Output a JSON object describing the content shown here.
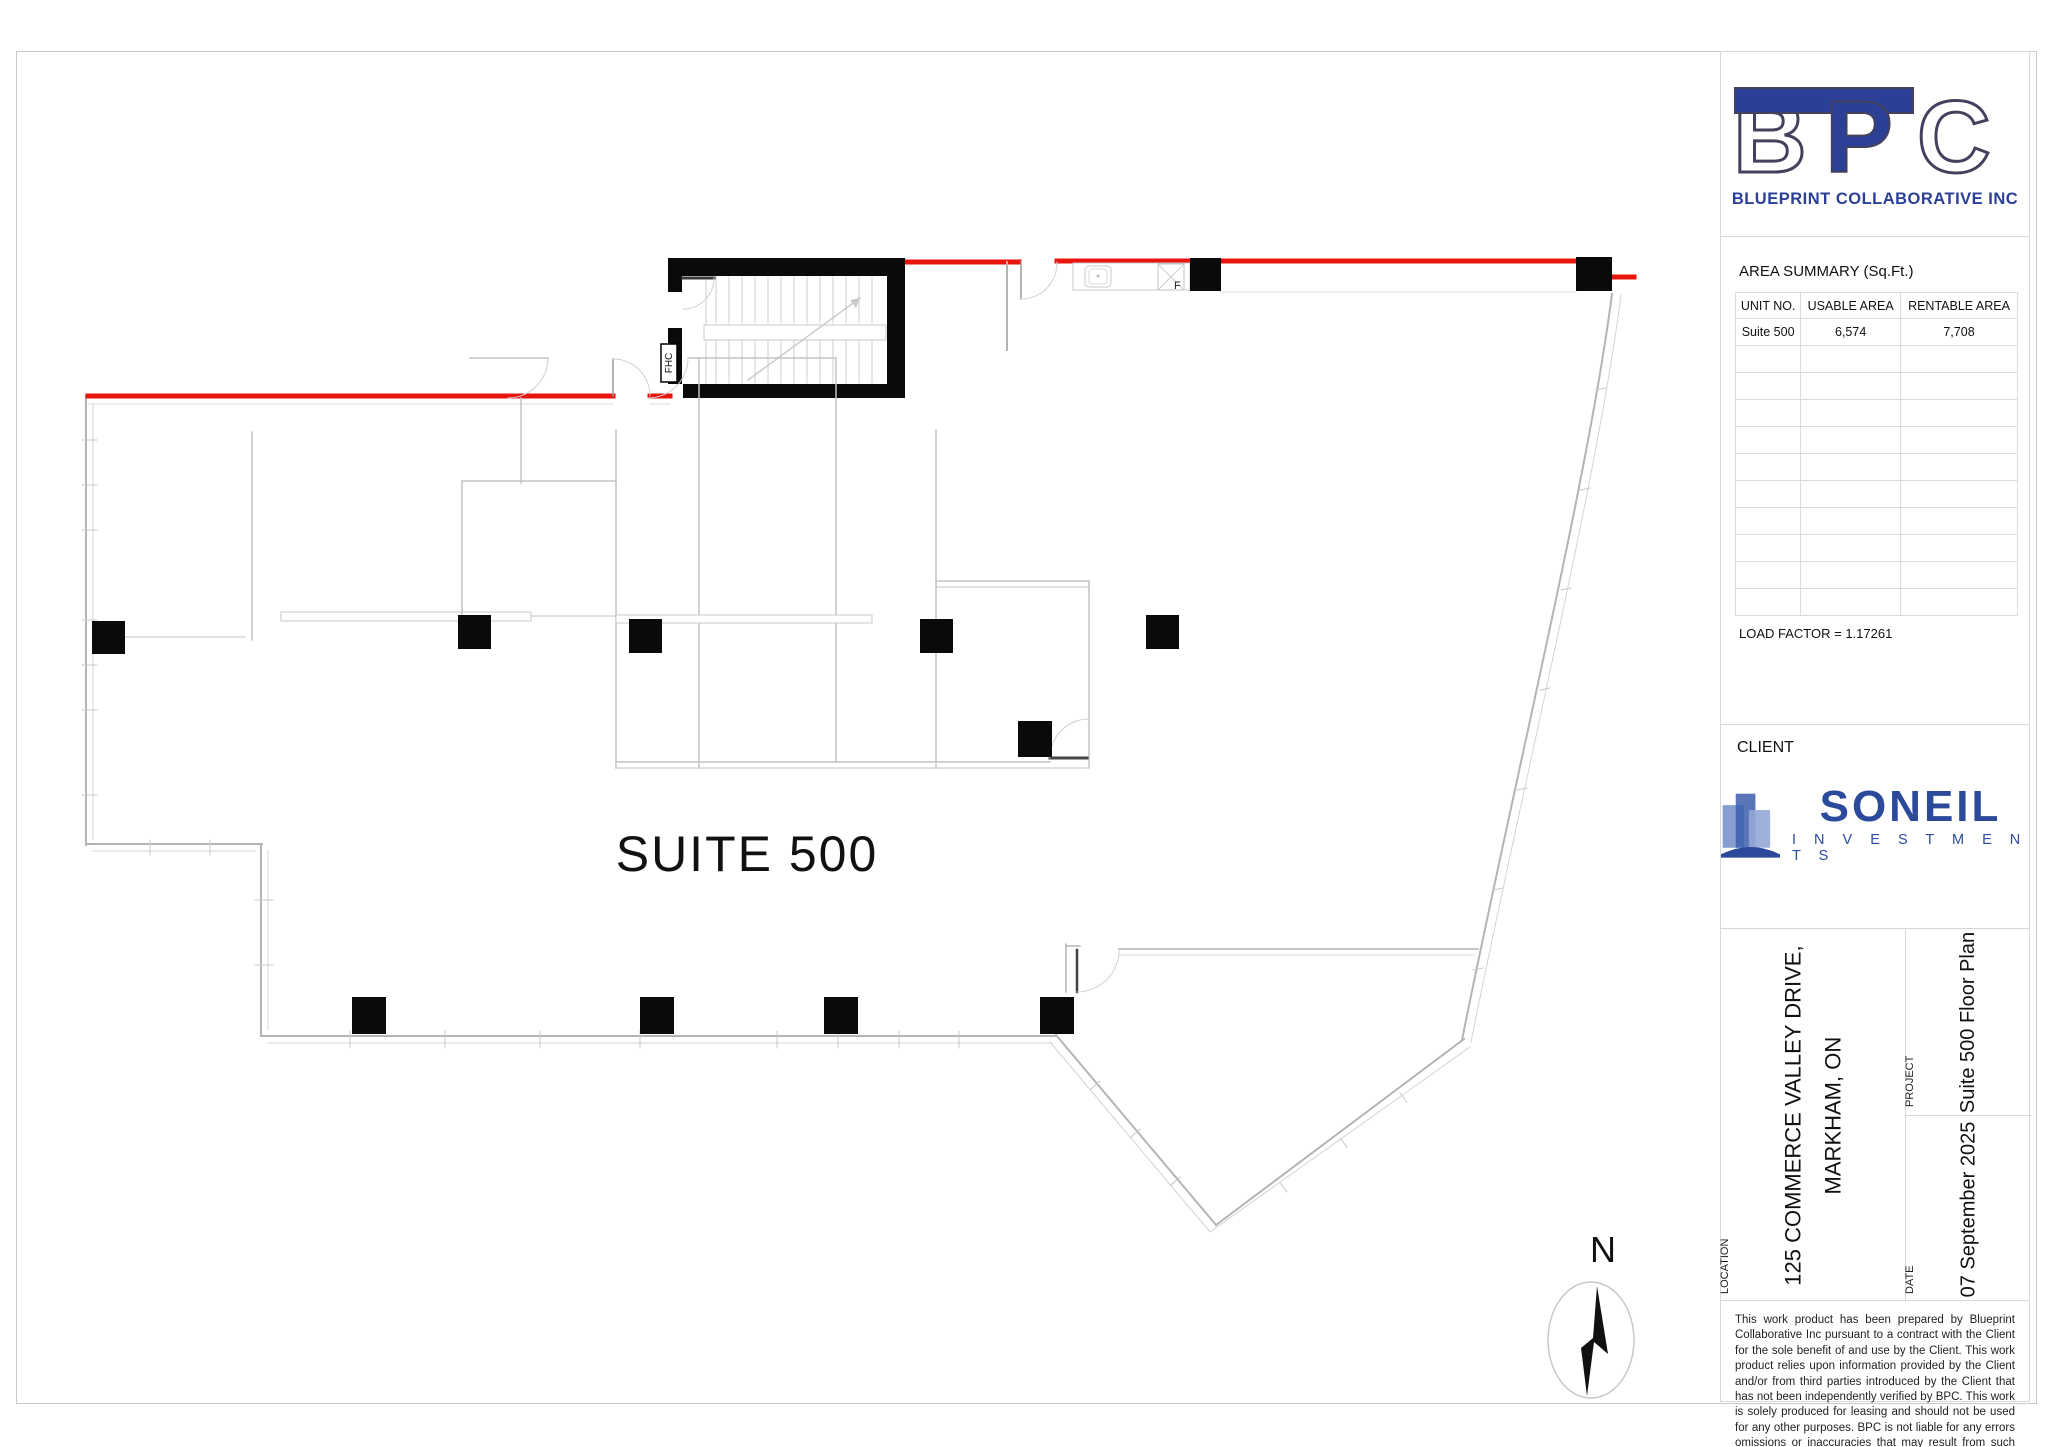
{
  "branding": {
    "letter_b": "B",
    "letter_p": "P",
    "letter_c": "C",
    "company_name": "BLUEPRINT COLLABORATIVE INC",
    "bpc_blue": "#2b3f96"
  },
  "area_summary": {
    "title": "AREA SUMMARY (Sq.Ft.)",
    "columns": [
      "UNIT NO.",
      "USABLE AREA",
      "RENTABLE AREA"
    ],
    "rows": [
      [
        "Suite 500",
        "6,574",
        "7,708"
      ],
      [
        "",
        "",
        ""
      ],
      [
        "",
        "",
        ""
      ],
      [
        "",
        "",
        ""
      ],
      [
        "",
        "",
        ""
      ],
      [
        "",
        "",
        ""
      ],
      [
        "",
        "",
        ""
      ],
      [
        "",
        "",
        ""
      ],
      [
        "",
        "",
        ""
      ],
      [
        "",
        "",
        ""
      ],
      [
        "",
        "",
        ""
      ]
    ],
    "load_factor": "LOAD FACTOR = 1.17261"
  },
  "client": {
    "label": "CLIENT",
    "name_primary": "SONEIL",
    "name_secondary": "I N V E S T M E N T S",
    "soneil_blue": "#2b4a9b"
  },
  "title_block": {
    "location_label": "LOCATION",
    "location_line1": "125 COMMERCE VALLEY DRIVE,",
    "location_line2": "MARKHAM, ON",
    "project_label": "PROJECT",
    "project_value": "Suite 500 Floor Plan",
    "date_label": "DATE",
    "date_value": "07 September 2025"
  },
  "disclaimer": "This work product has been prepared by Blueprint Collaborative Inc pursuant to a contract with the Client for the sole benefit of and use by the Client. This work product relies upon information provided by the Client and/or from third parties introduced by the Client that has not been independently verified by BPC. This work is solely produced for leasing and should not be used for any other purposes. BPC is not liable for any errors omissions or inaccuracies that may result from such information.",
  "plan": {
    "suite_label": "SUITE 500",
    "north_label": "N",
    "fhc_label": "FHC",
    "fixture_label": "F",
    "demising_red": "#e8140d"
  }
}
